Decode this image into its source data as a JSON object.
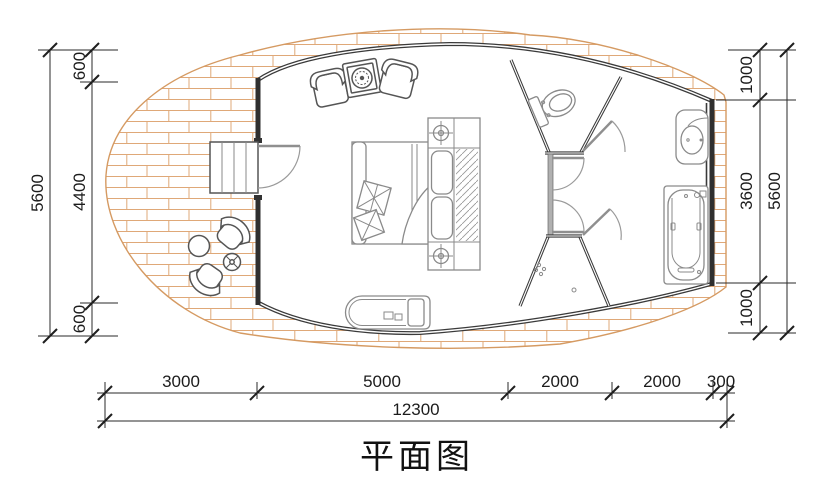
{
  "title": "平面图",
  "colors": {
    "background": "#ffffff",
    "wall": "#3a3a3a",
    "interior_wall": "#3a3a3a",
    "deck_outline": "#d59a62",
    "brick_hatch": "#dfa878",
    "furniture": "#8a8a8a",
    "deck_furniture": "#555555",
    "dimension": "#1c1c1c"
  },
  "dims": {
    "left": {
      "total": "5600",
      "top": "600",
      "middle": "4400",
      "bottom": "600"
    },
    "right": {
      "total": "5600",
      "top": "1000",
      "middle": "3600",
      "bottom": "1000"
    },
    "bottom": {
      "total": "12300",
      "segments": [
        "3000",
        "5000",
        "2000",
        "2000",
        "300"
      ]
    }
  },
  "furniture": [
    "armchair",
    "armchair",
    "fire-table",
    "bed",
    "pillow",
    "wardrobe-hatch",
    "nightstand-lamp",
    "nightstand-lamp",
    "chaise-lounge",
    "entry-steps",
    "entry-door",
    "toilet",
    "wash-basin",
    "bathtub",
    "shower-drain",
    "outdoor-chair",
    "outdoor-chair",
    "round-table",
    "side-table"
  ]
}
